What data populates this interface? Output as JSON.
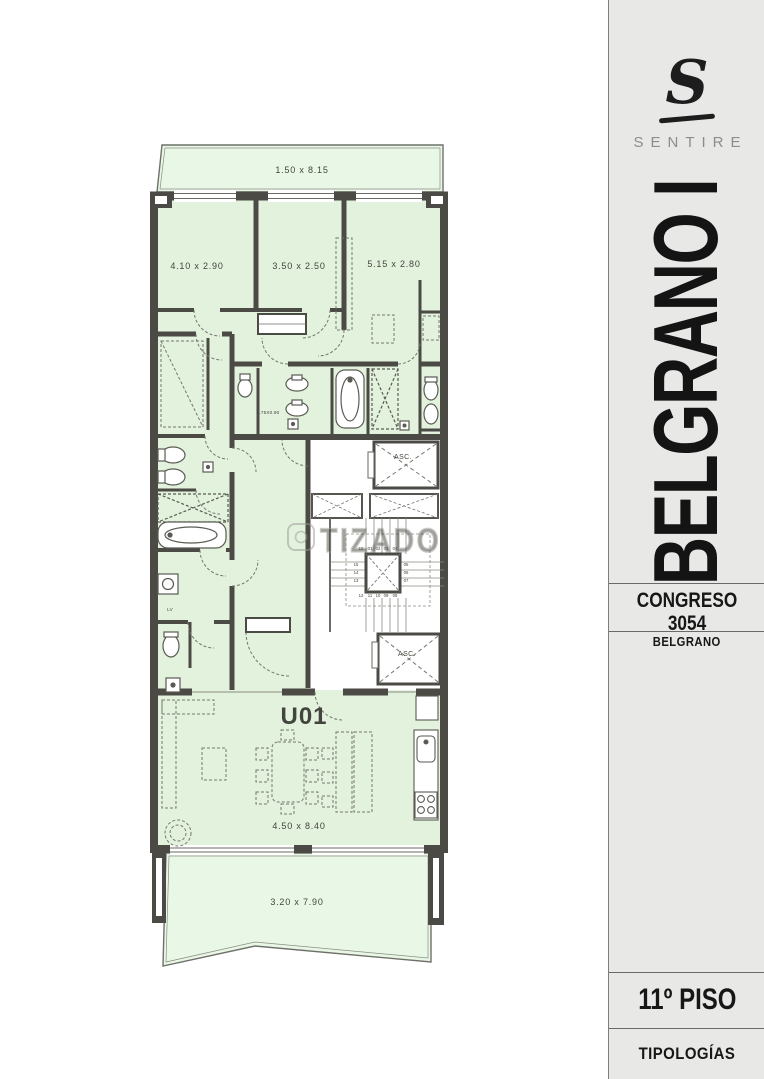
{
  "sidebar": {
    "logo_glyph": "S",
    "brand": "SENTIRE",
    "project": "BELGRANO I",
    "address": "CONGRESO 3054",
    "neighborhood": "BELGRANO",
    "floor": "11º PISO",
    "footer": "TIPOLOGÍAS"
  },
  "plan": {
    "unit_label": "U01",
    "watermark": "TIZADO",
    "dimensions": {
      "balcony_top": "1.50 x 8.15",
      "bedroom_1": "4.10 x 2.90",
      "bedroom_2": "3.50 x 2.50",
      "bedroom_3": "5.15 x 2.80",
      "bathroom_small": "1.75X0.90",
      "living": "4.50 x 8.40",
      "balcony_bottom": "3.20 x 7.90"
    },
    "labels": {
      "laundry": "LV"
    },
    "elevator_upper": "ASC.",
    "elevator_lower": "ASC.",
    "stairs": {
      "top": [
        "16",
        "01",
        "02",
        "03",
        "04"
      ],
      "right": [
        "05",
        "06",
        "07"
      ],
      "bottom": [
        "12",
        "11",
        "10",
        "09",
        "08"
      ],
      "left": [
        "15",
        "14",
        "13"
      ]
    },
    "colors": {
      "room_fill": "#e2f2dd",
      "balcony_fill": "#e9f8e6",
      "wall": "#4b4a45",
      "sidebar_bg": "#e8e8e7",
      "brand_gray": "#8d8d8d",
      "ink": "#171717"
    }
  }
}
